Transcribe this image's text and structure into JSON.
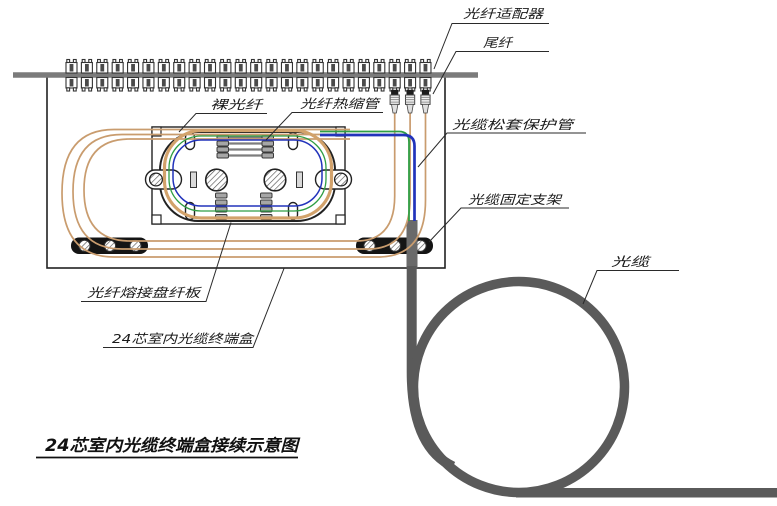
{
  "diagram": {
    "title": "24芯室内光缆终端盒接续示意图",
    "labels": {
      "adapter": "光纤适配器",
      "pigtail": "尾纤",
      "bare_fiber": "裸光纤",
      "heat_shrink_tube": "光纤热缩管",
      "loose_tube_protector": "光缆松套保护管",
      "cable_fix_bracket": "光缆固定支架",
      "cable": "光缆",
      "splice_tray": "光纤熔接盘纤板",
      "termination_box": "24芯室内光缆终端盒"
    },
    "counts": {
      "adapters": 24,
      "pigtails": 3,
      "splice_sleeves": 4,
      "spare_sleeve_rows": 4
    },
    "colors": {
      "fiber_tan": "#c99c6e",
      "fiber_tan_thick": "#d2a26b",
      "fiber_green": "#2f9e44",
      "fiber_blue": "#2233bb",
      "cable_gray": "#5a5a5a",
      "wall_bar_gray": "#7b7b7b",
      "sleeve_gray": "#a6a6a6",
      "outline_black": "#1a1a1a"
    }
  }
}
